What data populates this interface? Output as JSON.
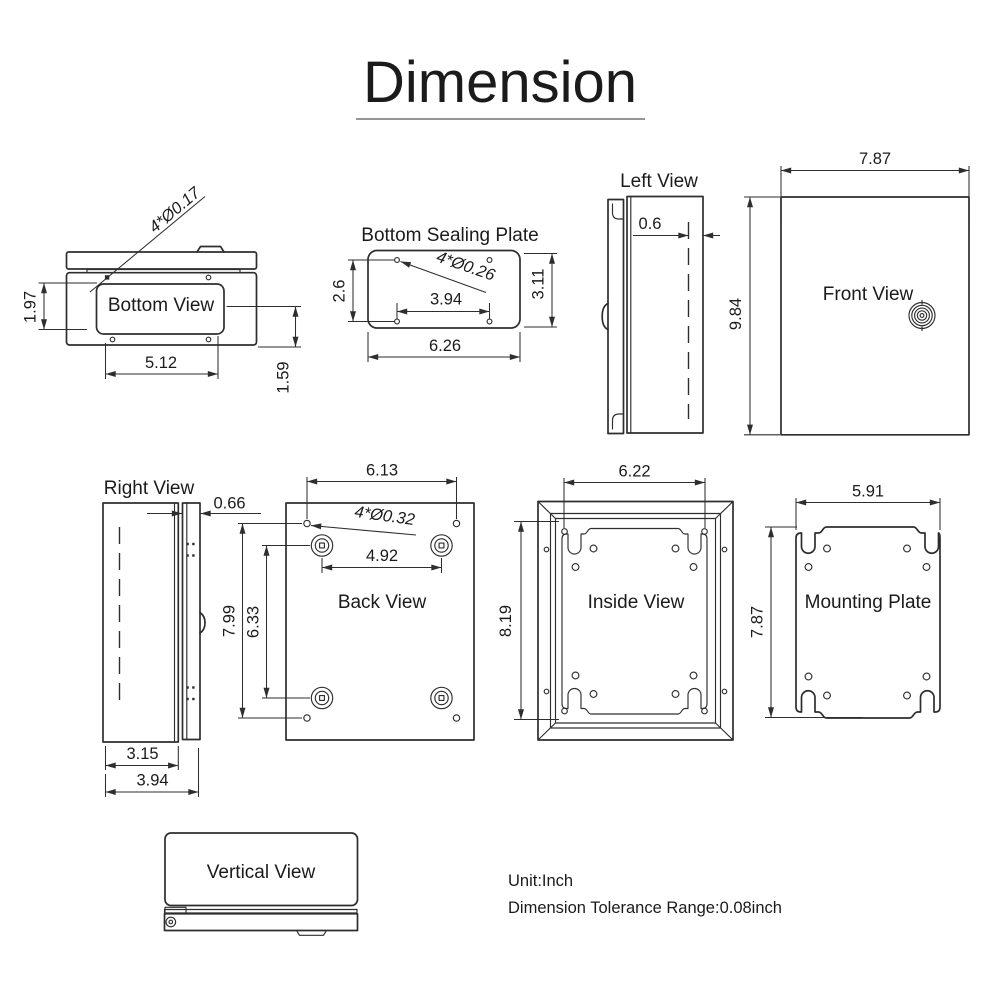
{
  "title": "Dimension",
  "views": {
    "bottom_view": {
      "label": "Bottom View",
      "hole_note": "4*Ø0.17",
      "dims": {
        "plate_height": "1.97",
        "plate_width": "5.12",
        "offset": "1.59"
      }
    },
    "bottom_sealing_plate": {
      "label": "Bottom Sealing Plate",
      "hole_note": "4*Ø0.26",
      "dims": {
        "hole_spacing_v": "2.6",
        "height": "3.11",
        "hole_spacing_h": "3.94",
        "width": "6.26"
      }
    },
    "left_view": {
      "label": "Left View",
      "dims": {
        "wall_offset": "0.6"
      }
    },
    "front_view": {
      "label": "Front View",
      "dims": {
        "width": "7.87",
        "height": "9.84"
      }
    },
    "right_view": {
      "label": "Right View",
      "dims": {
        "door_thickness": "0.66",
        "body_depth": "3.15",
        "total_depth": "3.94"
      }
    },
    "back_view": {
      "label": "Back View",
      "hole_note": "4*Ø0.32",
      "dims": {
        "hole_spacing_h": "6.13",
        "boss_spacing_h": "4.92",
        "hole_spacing_v": "7.99",
        "boss_spacing_v": "6.33"
      }
    },
    "inside_view": {
      "label": "Inside View",
      "dims": {
        "width": "6.22",
        "height": "8.19"
      }
    },
    "mounting_plate": {
      "label": "Mounting Plate",
      "dims": {
        "width": "5.91",
        "height": "7.87"
      }
    },
    "vertical_view": {
      "label": "Vertical View"
    }
  },
  "notes": {
    "unit": "Unit:Inch",
    "tolerance": "Dimension Tolerance Range:0.08inch"
  },
  "style": {
    "line_color": "#2e2e2e",
    "text_color": "#1b1b1b",
    "background": "#ffffff"
  }
}
